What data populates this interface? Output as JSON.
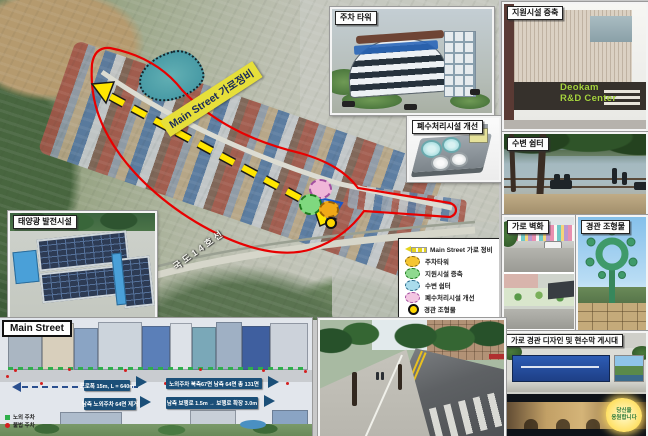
{
  "map": {
    "arrow_label": "Main Street 가로정비",
    "road_label": "국도14호선",
    "legend": {
      "items": [
        {
          "symbol": "dashed-arrow",
          "color": "#e4d31f",
          "label": "Main Street 가로 정비"
        },
        {
          "symbol": "blob",
          "color": "#f5c531",
          "label": "주차타워"
        },
        {
          "symbol": "blob",
          "color": "#8fd98f",
          "label": "지원시설 증축"
        },
        {
          "symbol": "blob",
          "color": "#aadcec",
          "label": "수변 쉼터"
        },
        {
          "symbol": "blob",
          "color": "#f3c6e2",
          "label": "폐수처리시설 개선"
        },
        {
          "symbol": "ring",
          "color": "#ffd700",
          "label": "경관 조형물"
        }
      ]
    }
  },
  "callouts": {
    "parking_tower": {
      "title": "주차 타워"
    },
    "wastewater": {
      "title": "폐수처리시설 개선"
    },
    "solar": {
      "title": "태양광 발전시설"
    },
    "support_expand": {
      "title": "지원시설 증축",
      "sign_line1": "Deokam",
      "sign_line2": "R&D Center"
    },
    "waterside": {
      "title": "수변 쉼터"
    },
    "mural": {
      "title": "가로 벽화"
    },
    "sculpture": {
      "title": "경관 조형물"
    },
    "banner": {
      "title": "가로 경관 디자인 및 현수막 게시대",
      "glow_line1": "당신을",
      "glow_line2": "응원합니다"
    }
  },
  "diagram": {
    "title": "Main Street",
    "callouts": {
      "before_top": "도로폭 15m, L = 640m",
      "after_top": "노외주차 북측67면 남측 64면 총 131면",
      "before_bottom": "남측 노외주차 64면 제거",
      "after_bottom": "남측 보행로 1.5m → 보행로 확장 3.0m"
    },
    "legend": [
      {
        "color": "#2faf4b",
        "label": "노외 주차"
      },
      {
        "color": "#d42020",
        "label": "불법 주차"
      }
    ]
  },
  "colors": {
    "boundary_red": "#e80000",
    "arrow_yellow": "#ffe600",
    "highlight_label": "#e6df3a",
    "callout_blue": "#1b4f78"
  }
}
